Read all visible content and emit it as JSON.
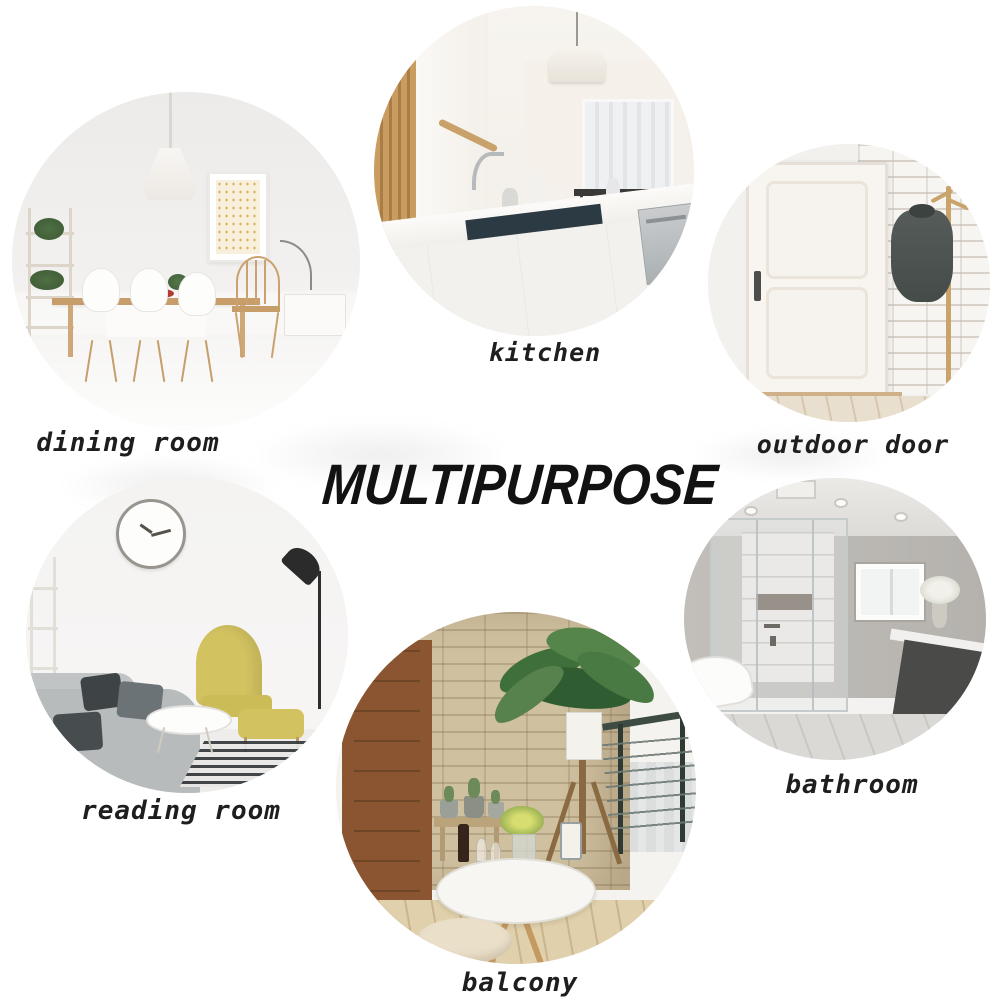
{
  "title": {
    "text": "MULTIPURPOSE"
  },
  "rooms": {
    "dining": {
      "label": "dining room"
    },
    "kitchen": {
      "label": "kitchen"
    },
    "outdoor": {
      "label": "outdoor door"
    },
    "reading": {
      "label": "reading room"
    },
    "bathroom": {
      "label": "bathroom"
    },
    "balcony": {
      "label": "balcony"
    }
  },
  "palette": {
    "background": "#ffffff",
    "text": "#1e1e1e",
    "title_text": "#121212",
    "wood": "#c79d6a",
    "accent_yellow": "#d2c260",
    "stone_wall": "#cfc0a0",
    "brick_red": "#a34a30",
    "plant_green": "#4c7342",
    "sofa_gray": "#b7bbbc",
    "jacket_gray": "#4e5451",
    "sink_dark": "#2c3a44"
  }
}
